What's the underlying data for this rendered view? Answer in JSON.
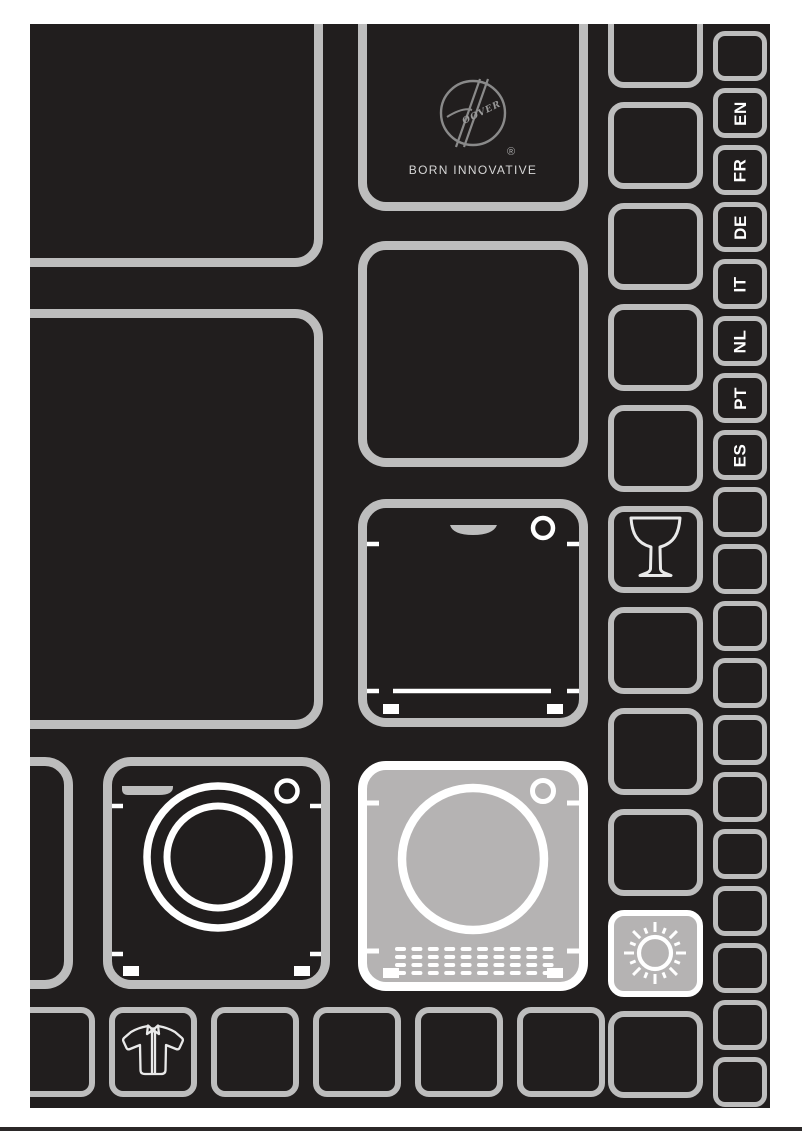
{
  "header": {
    "logo": {
      "brand": "Hoover",
      "letters": "OOVER",
      "registered": "®",
      "tagline": "BORN INNOVATIVE"
    }
  },
  "language_tabs": [
    "EN",
    "FR",
    "DE",
    "IT",
    "NL",
    "PT",
    "ES"
  ],
  "tiles": {
    "icon_names": [
      "hoover-logo",
      "dishwasher-icon",
      "washing-machine-icon",
      "tumble-dryer-icon",
      "wine-glass-icon",
      "sun-icon",
      "shirt-icon"
    ],
    "highlighted": [
      "tumble-dryer-tile",
      "sun-tile"
    ]
  },
  "colors": {
    "page_background": "#ffffff",
    "canvas_background": "#211e1e",
    "tile_border": "#bdbdbd",
    "highlight_fill": "#b5b3b3",
    "icon_stroke": "#ffffff",
    "logo_stroke": "#8a8a8a",
    "tagline_text": "#d6d6d6"
  }
}
